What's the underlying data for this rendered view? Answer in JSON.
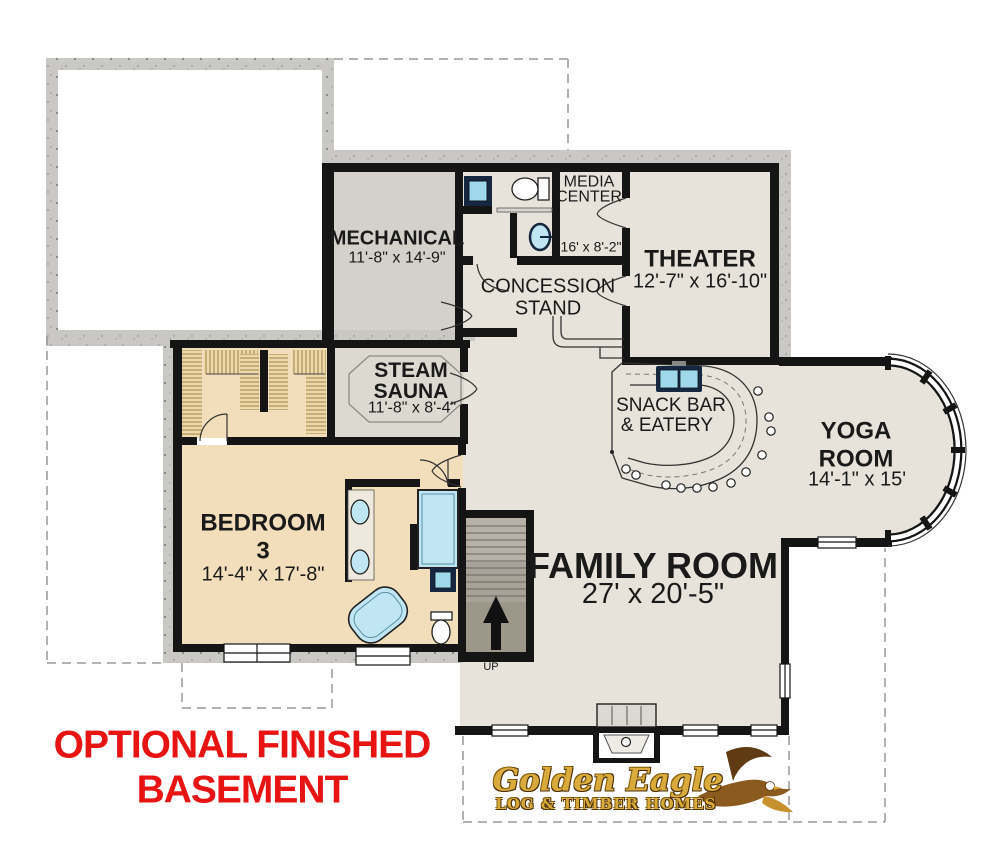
{
  "rooms": {
    "mechanical": {
      "name": "MECHANICAL",
      "dims": "11'-8\" x 14'-9\""
    },
    "media_center": {
      "line1": "MEDIA",
      "line2": "CENTER",
      "dims": "16' x 8'-2\""
    },
    "theater": {
      "name": "THEATER",
      "dims": "12'-7\" x 16'-10\""
    },
    "concession": {
      "line1": "CONCESSION",
      "line2": "STAND"
    },
    "steam_sauna": {
      "line1": "STEAM",
      "line2": "SAUNA",
      "dims": "11'-8\" x 8'-4\""
    },
    "snack_bar": {
      "line1": "SNACK BAR",
      "line2": "& EATERY"
    },
    "yoga": {
      "line1": "YOGA",
      "line2": "ROOM",
      "dims": "14'-1\" x 15'"
    },
    "bedroom3": {
      "line1": "BEDROOM",
      "line2": "3",
      "dims": "14'-4\" x 17'-8\""
    },
    "family": {
      "name": "FAMILY ROOM",
      "dims": "27' x 20'-5\""
    }
  },
  "stairs": {
    "label": "UP"
  },
  "caption": {
    "line1": "OPTIONAL FINISHED",
    "line2": "BASEMENT"
  },
  "logo": {
    "name": "Golden Eagle",
    "tagline": "LOG & TIMBER HOMES"
  },
  "colors": {
    "caption_red": "#e81414",
    "logo_gold": "#d9ab3c",
    "floor_beige": "#e7e3da",
    "floor_tan": "#f2debb",
    "floor_gray": "#d3d1ca",
    "wall_black": "#151515",
    "concrete_gray": "#c9c8c4",
    "fixture_blue": "#bfe6f2"
  }
}
